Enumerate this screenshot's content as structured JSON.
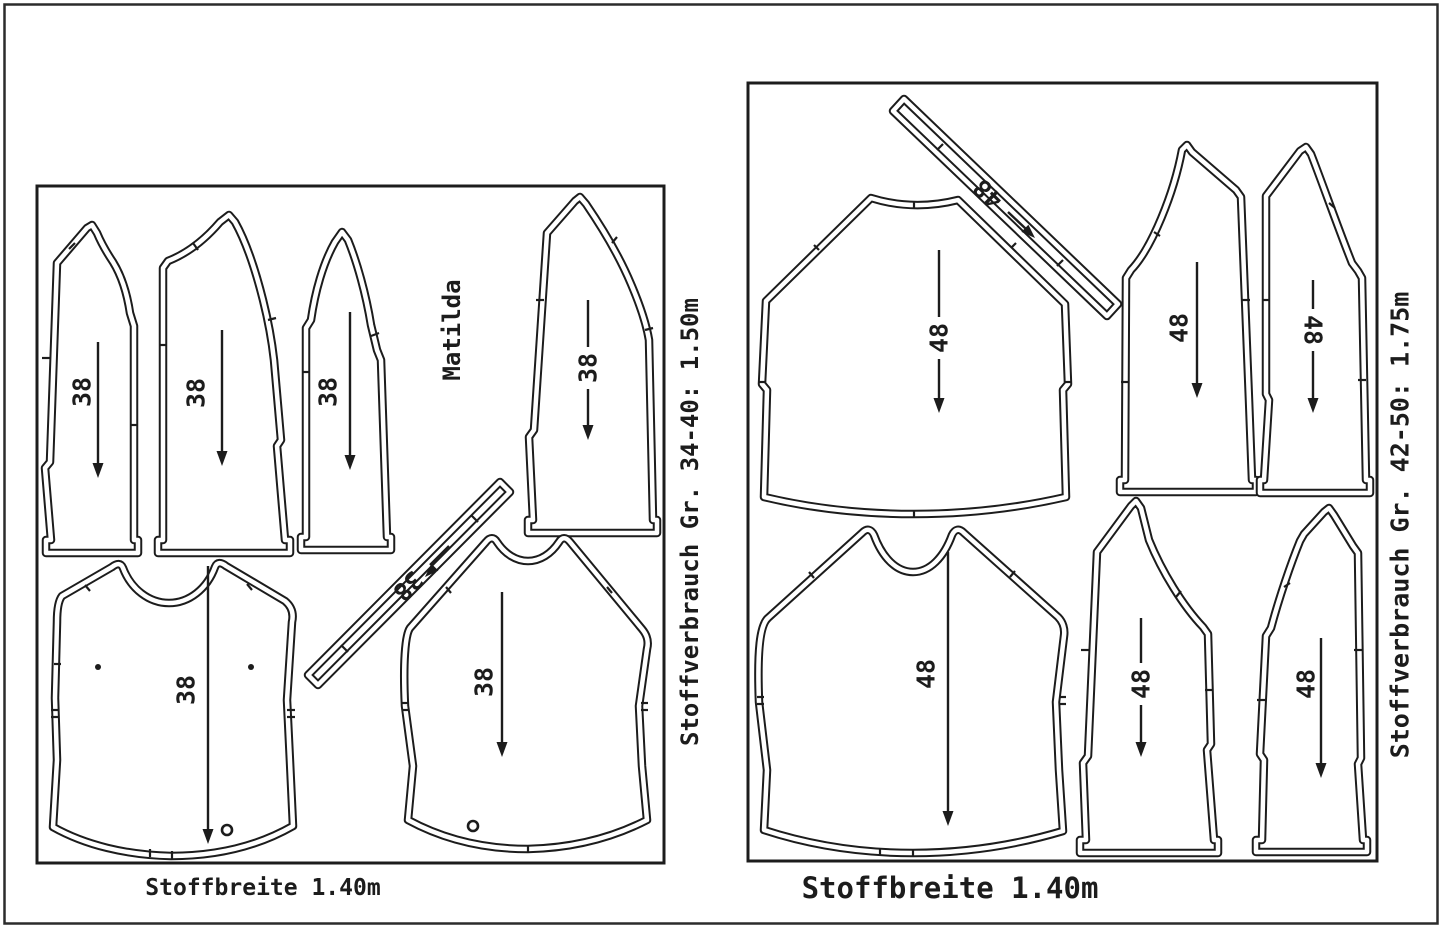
{
  "document": {
    "pattern_name": "Matilda"
  },
  "left_layout": {
    "consumption_label": "Stoffverbrauch Gr. 34-40: 1.50m",
    "fabric_width_label": "Stoffbreite 1.40m",
    "size_labels": [
      "38",
      "38",
      "38",
      "38",
      "38",
      "38",
      "38"
    ]
  },
  "right_layout": {
    "consumption_label": "Stoffverbrauch Gr. 42-50: 1.75m",
    "fabric_width_label": "Stoffbreite 1.40m",
    "size_labels": [
      "48",
      "48",
      "48",
      "48",
      "48",
      "48",
      "48"
    ]
  },
  "colors": {
    "line": "#1c1c1c",
    "background": "#ffffff"
  }
}
